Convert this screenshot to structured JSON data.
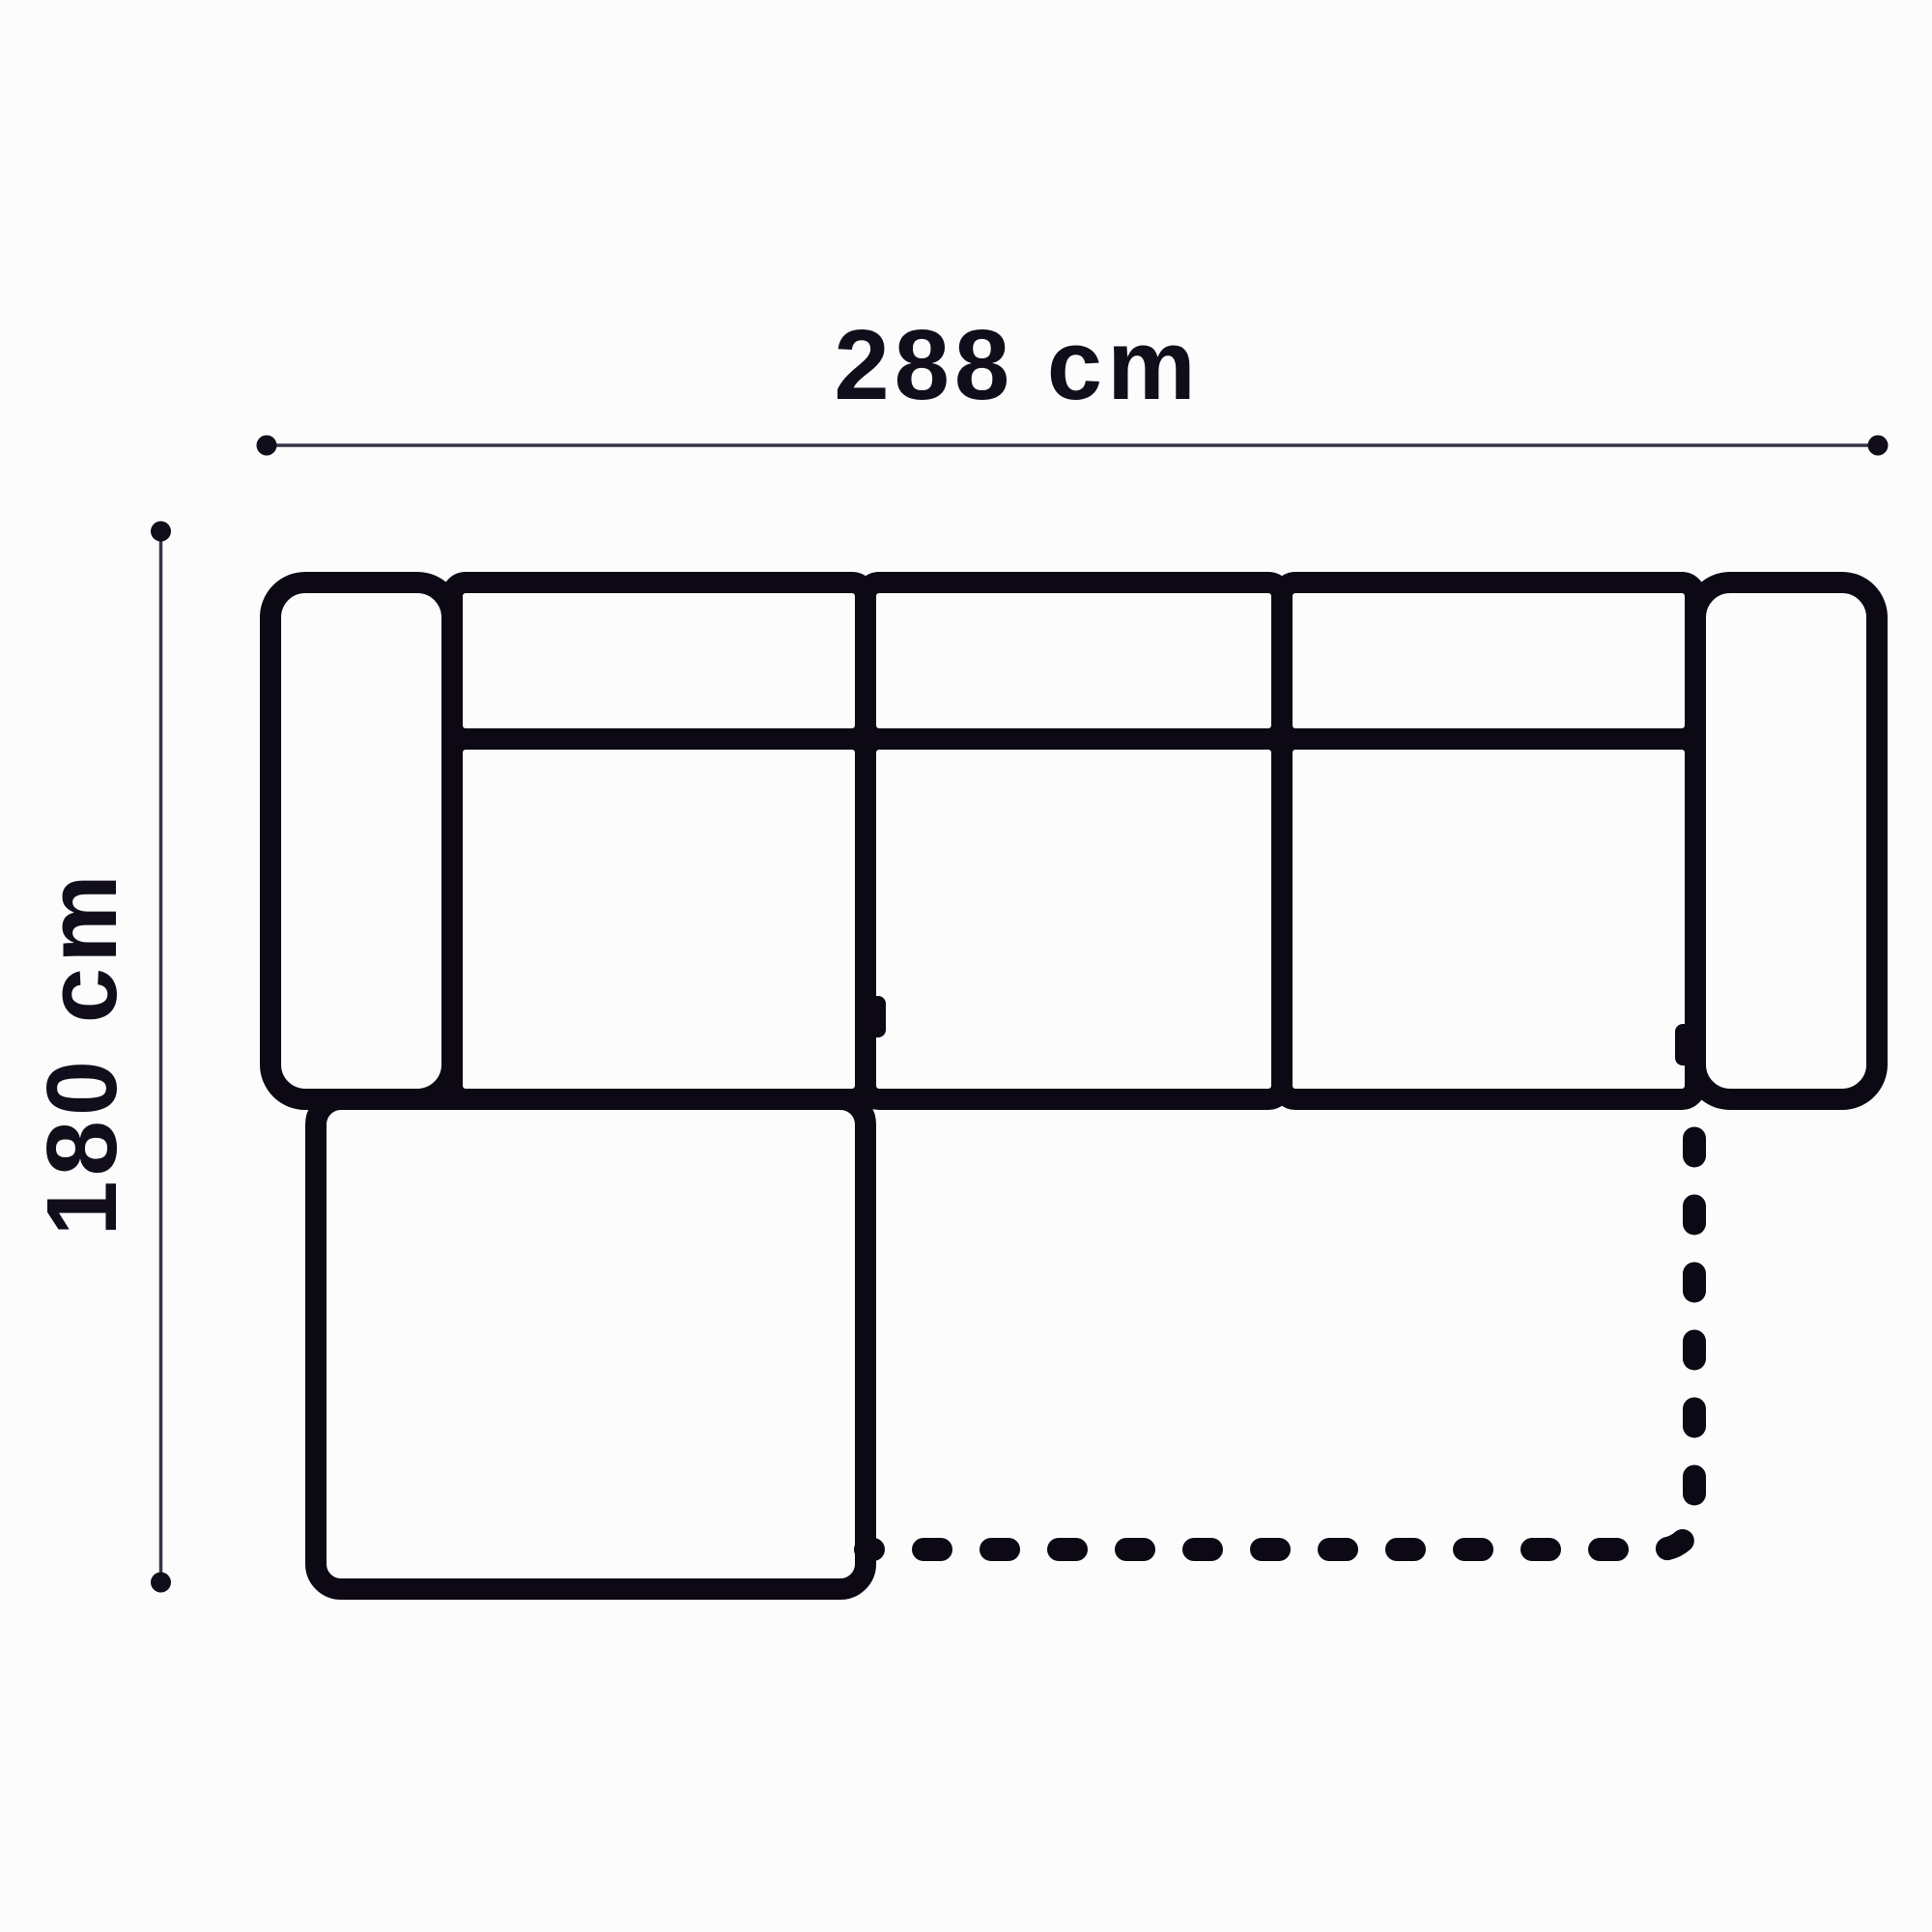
{
  "diagram": {
    "dimension_width": {
      "label": "288 cm"
    },
    "dimension_height": {
      "label": "180 cm"
    },
    "colors": {
      "background": "#fcfcfc",
      "outline": "#0c0814",
      "dimension_line": "#39334a",
      "marker": "#110d1a",
      "label_text": "#110d1a"
    }
  }
}
